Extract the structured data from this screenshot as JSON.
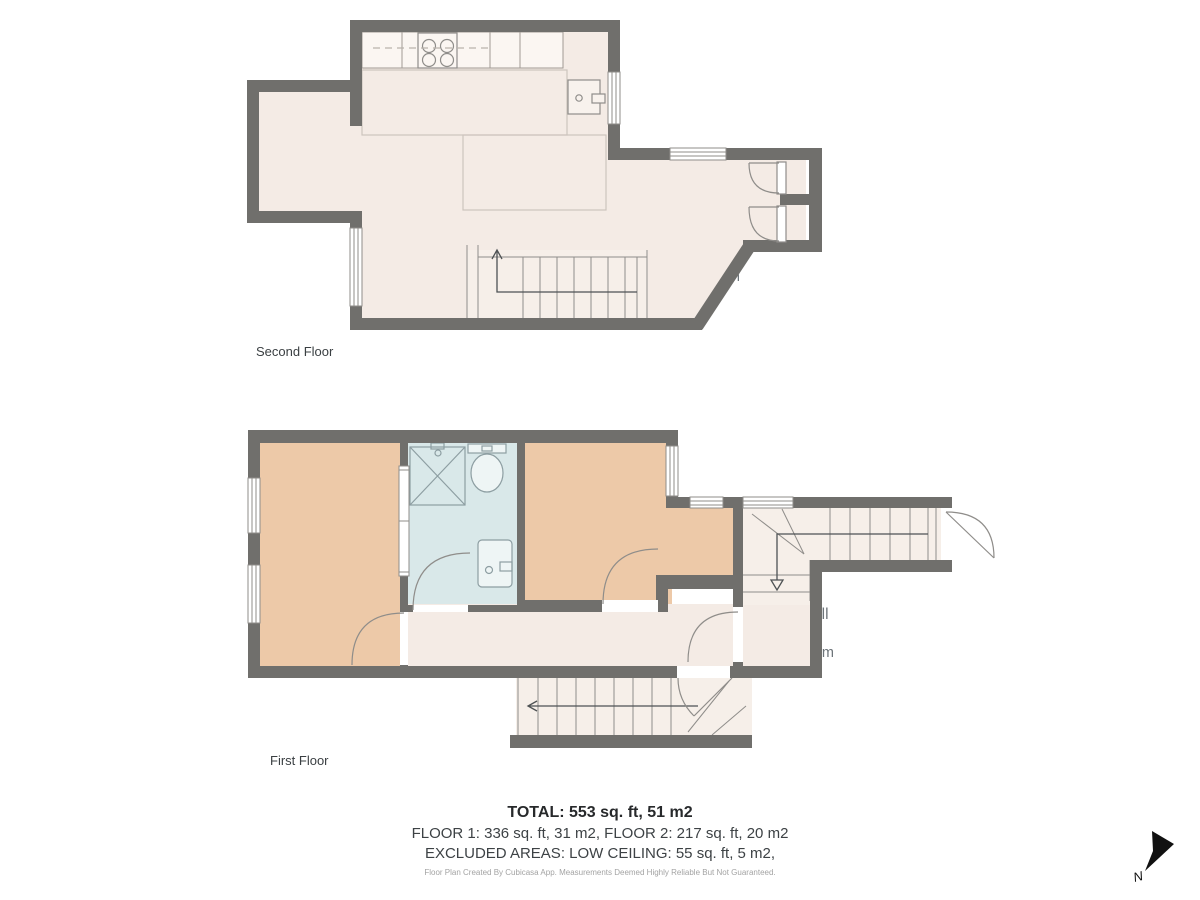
{
  "floors": [
    {
      "label": "Second Floor",
      "rooms": [
        {
          "name": "Kitchen",
          "imperial": "17' x 8'",
          "metric": "5.28 m x 2.30 m"
        },
        {
          "name": "Living Room",
          "imperial": "12' x 7'",
          "metric": "3.73 m x 2.13 m"
        },
        {
          "name": "Dining Area",
          "imperial": "9' x 8'",
          "metric": "2.59 m x 2.48 m"
        }
      ]
    },
    {
      "label": "First Floor",
      "rooms": [
        {
          "name": "Bedroom",
          "imperial": "7' x 11'",
          "metric": "2.16 m x 3.42 m"
        },
        {
          "name": "Shower Room",
          "imperial": "6' x 8'",
          "metric": "1.67 m x 2.49 m"
        },
        {
          "name": "Bedroom",
          "imperial": "10' x 8'",
          "metric": "3.18 m x 2.49 m"
        },
        {
          "name": "Hall",
          "imperial": "16' x 4'",
          "metric": "4.95 m x 1.29 m"
        },
        {
          "name": "Entrance Hall",
          "imperial": "3' x 4'",
          "metric": "1.03 m x 1.19 m"
        }
      ]
    }
  ],
  "summary": {
    "total": "TOTAL: 553 sq. ft, 51 m2",
    "floors_line": "FLOOR 1: 336 sq. ft, 31 m2, FLOOR 2: 217 sq. ft, 20 m2",
    "excluded": "EXCLUDED AREAS: LOW CEILING: 55 sq. ft, 5 m2,",
    "disclaimer": "Floor Plan Created By Cubicasa App. Measurements Deemed Highly Reliable But Not Guaranteed."
  },
  "compass": {
    "label": "N"
  },
  "colors": {
    "wall": "#706f6c",
    "floor": "#f4ebe5",
    "bedroom": "#edc9a8",
    "wet_room": "#d9e8e9",
    "stairs": "#f6efe9",
    "label_text": "#6d7479"
  }
}
